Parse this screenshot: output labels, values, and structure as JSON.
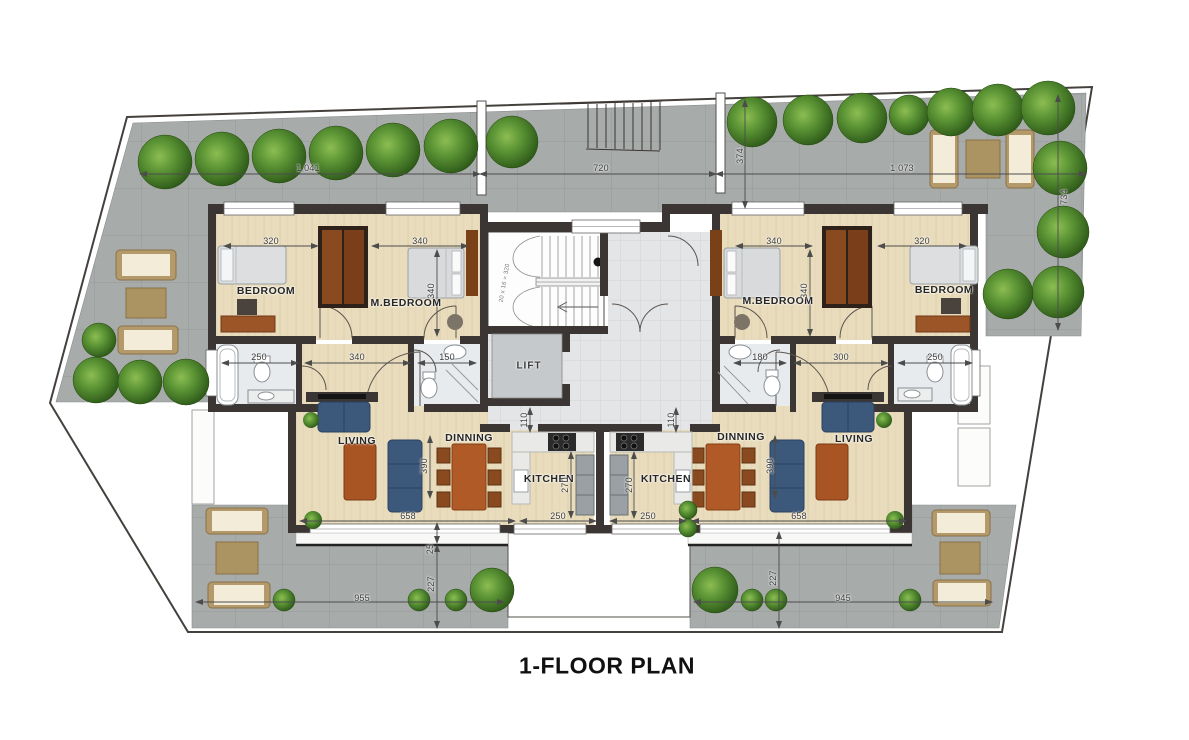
{
  "title": "1-FLOOR PLAN",
  "rooms": {
    "left": {
      "bedroom": "BEDROOM",
      "master_bedroom": "M.BEDROOM",
      "living": "LIVING",
      "dining": "DINNING",
      "kitchen": "KITCHEN"
    },
    "right": {
      "bedroom": "BEDROOM",
      "master_bedroom": "M.BEDROOM",
      "living": "LIVING",
      "dining": "DINNING",
      "kitchen": "KITCHEN"
    },
    "core": {
      "lift": "LIFT",
      "stair_note": "20 x 16 = 320"
    }
  },
  "dimensions": {
    "site": {
      "top_left": "1 041",
      "top_center": "720",
      "top_right": "1 073",
      "top_depth": "374",
      "right_depth": "734"
    },
    "left_unit": {
      "bedroom_width": "320",
      "master_width": "340",
      "bedroom_depth": "340",
      "bath_width": "250",
      "hall_width": "340",
      "ensuite_width": "150",
      "entry_depth": "110",
      "living_depth": "390",
      "kitchen_depth": "270",
      "living_width": "658",
      "kitchen_width": "250"
    },
    "right_unit": {
      "master_width": "340",
      "bedroom_width": "320",
      "bedroom_depth": "340",
      "ensuite_width": "180",
      "hall_width": "300",
      "bath_width": "250",
      "entry_depth": "110",
      "living_depth": "390",
      "kitchen_depth": "270",
      "living_width": "658",
      "kitchen_width": "250"
    },
    "bottom_left_terrace": {
      "width": "955",
      "depth": "227",
      "balcony": "25"
    },
    "bottom_right_terrace": {
      "width": "945",
      "depth": "227"
    }
  },
  "palette": {
    "terrace": "#a7abaa",
    "wood_floor": "#e9dcbc",
    "wall": "#3b3633",
    "sofa": "#3c587b",
    "wood_furniture": "#b05a28",
    "greenery": "#4c7a28",
    "bath": "#e8ebee"
  }
}
